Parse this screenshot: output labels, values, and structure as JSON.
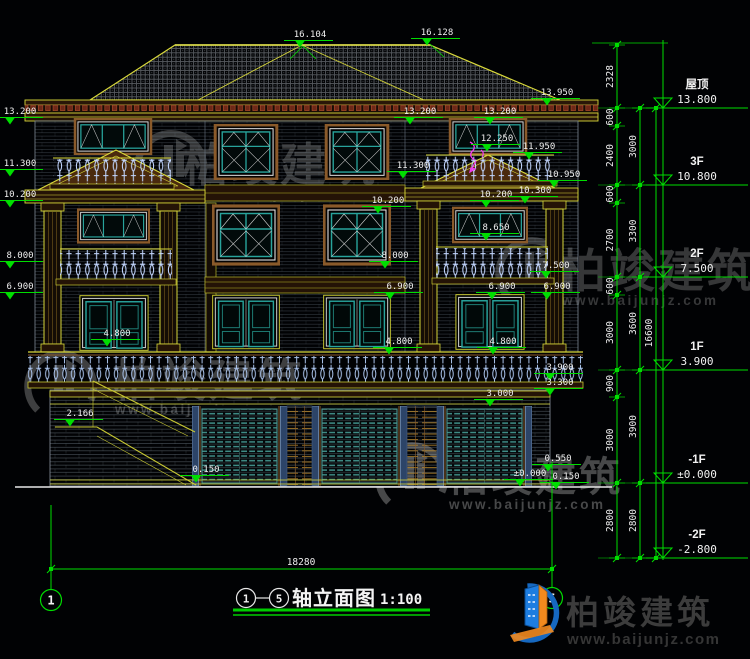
{
  "drawing": {
    "title": {
      "axis_from": "1",
      "axis_to": "5",
      "name": "轴立面图",
      "scale": "1:100"
    },
    "overall_dim": {
      "text": "18280",
      "x1": 51,
      "x2": 552,
      "y": 569,
      "tx": 301,
      "ty": 565
    },
    "grid_axes": [
      {
        "label": "1",
        "x": 51,
        "cy": 600,
        "top": 505,
        "bot": 589
      },
      {
        "label": "5",
        "x": 552,
        "cy": 598,
        "top": 462,
        "bot": 587
      }
    ],
    "levels": [
      {
        "label": "屋顶",
        "value": "13.800",
        "y": 108
      },
      {
        "label": "3F",
        "value": "10.800",
        "y": 185
      },
      {
        "label": "2F",
        "value": "7.500",
        "y": 277
      },
      {
        "label": "1F",
        "value": "3.900",
        "y": 370
      },
      {
        "label": "-1F",
        "value": "±0.000",
        "y": 483
      },
      {
        "label": "-2F",
        "value": "-2.800",
        "y": 558
      }
    ],
    "chains": [
      {
        "x": 617,
        "segments": [
          [
            "2328",
            45,
            108
          ],
          [
            "600",
            108,
            126
          ],
          [
            "2400",
            126,
            185
          ],
          [
            "600",
            185,
            203
          ],
          [
            "2700",
            203,
            277
          ],
          [
            "600",
            277,
            295
          ],
          [
            "3000",
            295,
            370
          ],
          [
            "900",
            370,
            397
          ],
          [
            "3000",
            397,
            483
          ],
          [
            "2800",
            483,
            558
          ]
        ]
      },
      {
        "x": 640,
        "segments": [
          [
            "3000",
            108,
            185
          ],
          [
            "3300",
            185,
            277
          ],
          [
            "3600",
            277,
            370
          ],
          [
            "3900",
            370,
            483
          ],
          [
            "2800",
            483,
            558
          ]
        ]
      },
      {
        "x": 656,
        "segments": [
          [
            "16600",
            108,
            558
          ]
        ]
      }
    ],
    "markers": [
      {
        "v": "16.104",
        "x": 310,
        "y": 37
      },
      {
        "v": "16.128",
        "x": 437,
        "y": 35
      },
      {
        "v": "13.950",
        "x": 557,
        "y": 95
      },
      {
        "v": "13.200",
        "x": 20,
        "y": 114
      },
      {
        "v": "13.200",
        "x": 420,
        "y": 114
      },
      {
        "v": "13.200",
        "x": 500,
        "y": 114
      },
      {
        "v": "12.250",
        "x": 497,
        "y": 141
      },
      {
        "v": "11.950",
        "x": 539,
        "y": 149
      },
      {
        "v": "11.300",
        "x": 20,
        "y": 166
      },
      {
        "v": "11.300",
        "x": 413,
        "y": 168
      },
      {
        "v": "10.950",
        "x": 564,
        "y": 177
      },
      {
        "v": "10.200",
        "x": 20,
        "y": 197
      },
      {
        "v": "10.200",
        "x": 388,
        "y": 203
      },
      {
        "v": "10.200",
        "x": 496,
        "y": 197
      },
      {
        "v": "10.300",
        "x": 535,
        "y": 193
      },
      {
        "v": "8.650",
        "x": 496,
        "y": 230
      },
      {
        "v": "8.000",
        "x": 20,
        "y": 258
      },
      {
        "v": "8.000",
        "x": 395,
        "y": 258
      },
      {
        "v": "7.500",
        "x": 556,
        "y": 268
      },
      {
        "v": "6.900",
        "x": 20,
        "y": 289
      },
      {
        "v": "6.900",
        "x": 400,
        "y": 289
      },
      {
        "v": "6.900",
        "x": 502,
        "y": 289
      },
      {
        "v": "6.900",
        "x": 557,
        "y": 289
      },
      {
        "v": "4.800",
        "x": 117,
        "y": 336
      },
      {
        "v": "4.800",
        "x": 399,
        "y": 344
      },
      {
        "v": "4.800",
        "x": 503,
        "y": 344
      },
      {
        "v": "3.900",
        "x": 560,
        "y": 370
      },
      {
        "v": "3.300",
        "x": 560,
        "y": 385
      },
      {
        "v": "3.000",
        "x": 500,
        "y": 396
      },
      {
        "v": "2.166",
        "x": 80,
        "y": 416
      },
      {
        "v": "0.550",
        "x": 558,
        "y": 461
      },
      {
        "v": "±0.000",
        "x": 530,
        "y": 476
      },
      {
        "v": "0.150",
        "x": 206,
        "y": 472
      },
      {
        "v": "0.150",
        "x": 566,
        "y": 479
      }
    ]
  },
  "watermark": {
    "brand": "柏竣建筑",
    "url": "www.baijunjz.com",
    "instances": [
      {
        "gx": 172,
        "gy": 165,
        "tx": 280,
        "ty": 181,
        "anchor": "middle",
        "fs": 46,
        "o": 0.38
      },
      {
        "gx": 533,
        "gy": 272,
        "tx": 560,
        "ty": 287,
        "anchor": "start",
        "fs": 46,
        "o": 0.38
      },
      {
        "gx": 62,
        "gy": 385,
        "tx": 113,
        "ty": 396,
        "anchor": "start",
        "fs": 45,
        "o": 0.44
      },
      {
        "gx": 413,
        "gy": 477,
        "tx": 447,
        "ty": 491,
        "anchor": "start",
        "fs": 41,
        "o": 0.5
      }
    ]
  },
  "logo": {
    "brand": "柏竣建筑",
    "url": "www.baijunjz.com"
  },
  "colors": {
    "green": "#00dd00",
    "yellow": "#d9d93a",
    "teal": "#28a49c",
    "brown": "#8a5a2a",
    "baluster": "#bcd2ff",
    "text": "#f0f0f0",
    "magenta": "#f23cf2"
  }
}
